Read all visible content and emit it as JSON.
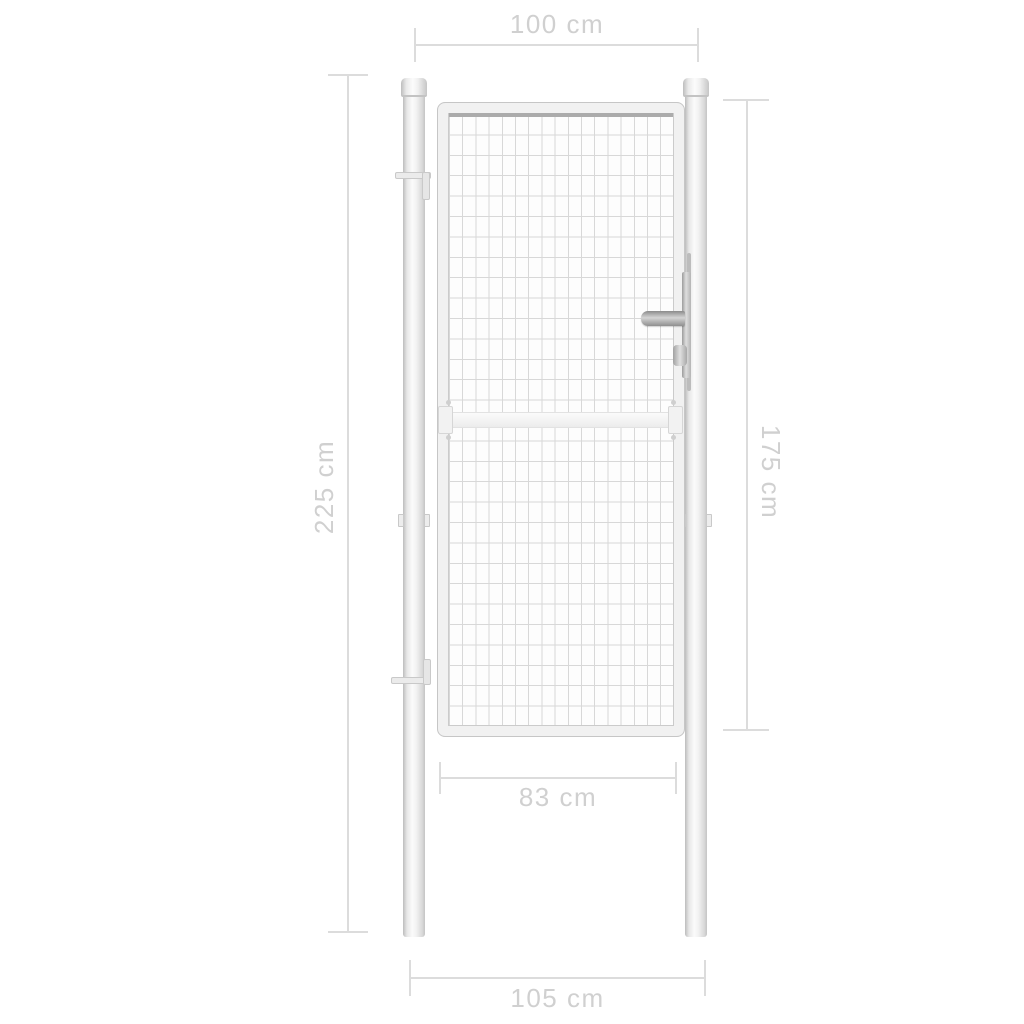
{
  "diagram": {
    "title": "Garden gate dimension diagram",
    "background": "#ffffff",
    "colors": {
      "dimension_line": "#dcdcdc",
      "dimension_text": "#d0d0d0",
      "metal_highlight": "#fbfbfb",
      "metal_shadow": "#bdbdbd",
      "mesh_line": "#d8d8d8",
      "mesh_top_wire": "#ababab",
      "handle_metal": "#8f8f8f"
    },
    "dimensions": [
      {
        "id": "gate-width-top",
        "label": "100 cm",
        "orientation": "horizontal",
        "position": "top"
      },
      {
        "id": "post-height-left",
        "label": "225 cm",
        "orientation": "vertical",
        "position": "left"
      },
      {
        "id": "gate-height-right",
        "label": "175 cm",
        "orientation": "vertical",
        "position": "right"
      },
      {
        "id": "gate-inner-width",
        "label": "83 cm",
        "orientation": "horizontal",
        "position": "below-gate"
      },
      {
        "id": "overall-width-bottom",
        "label": "105 cm",
        "orientation": "horizontal",
        "position": "bottom"
      }
    ]
  }
}
